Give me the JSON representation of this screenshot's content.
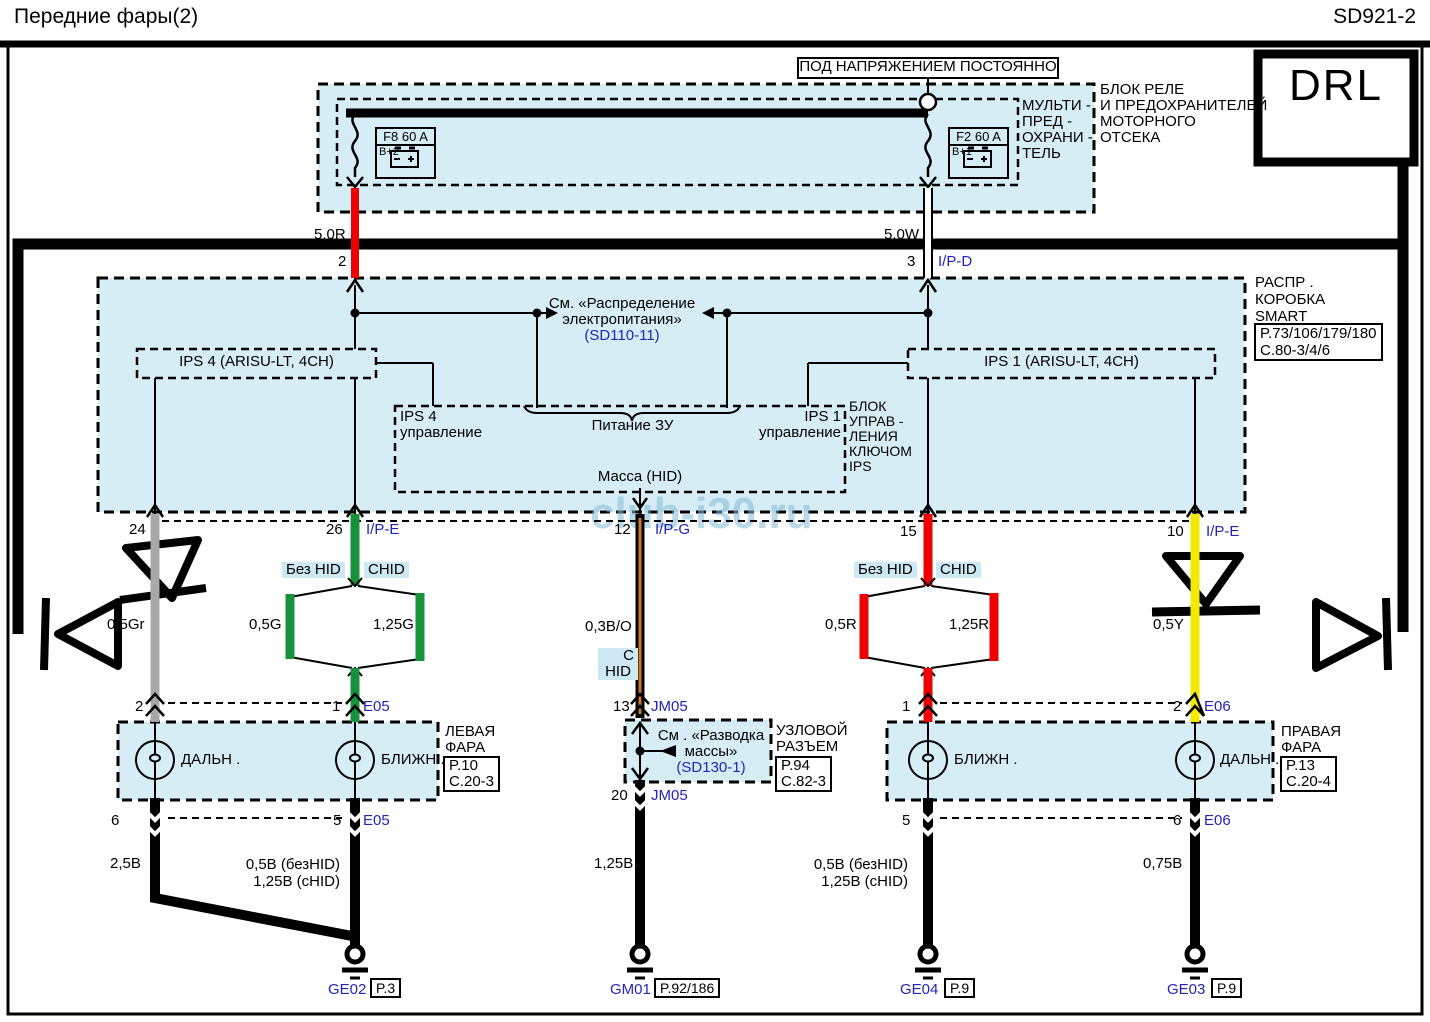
{
  "header": {
    "title": "Передние  фары(2)",
    "code": "SD921-2"
  },
  "drl": "DRL",
  "watermark": "club-i30.ru",
  "power_label": "ПОД НАПРЯЖЕНИЕМ    ПОСТОЯННО",
  "engine_fusebox": {
    "line1": "БЛОК  РЕЛЕ",
    "line2": "И ПРЕДОХРАНИТЕЛЕЙ",
    "line3": "МОТОРНОГО",
    "line4": "ОТСЕКА",
    "multi1": "МУЛЬТИ -",
    "multi2": "ПРЕД -",
    "multi3": "ОХРАНИ -",
    "multi4": "ТЕЛЬ",
    "fuse_f8": {
      "name": "F8 60 A",
      "terminal": "B+2"
    },
    "fuse_f2": {
      "name": "F2 60 A",
      "terminal": "B+1"
    }
  },
  "feeds": {
    "left": {
      "wire": "5.0R",
      "pin": "2"
    },
    "right": {
      "wire": "5.0W",
      "pin": "3",
      "connector": "I/P-D"
    }
  },
  "ips_block": {
    "see1": "См. «Распределение",
    "see2": "электропитания»",
    "see3": "(SD110-11)",
    "ips4": "IPS 4 (ARISU-LT, 4CH)",
    "ips1": "IPS 1 (ARISU-LT, 4CH)",
    "ctrl4a": "IPS 4",
    "ctrl4b": "управление",
    "supply": "Питание ЗУ",
    "ctrl1a": "IPS 1",
    "ctrl1b": "управление",
    "mass": "Масса (HID)",
    "name1": "БЛОК",
    "name2": "УПРАВ -",
    "name3": "ЛЕНИЯ",
    "name4": "КЛЮЧОМ",
    "name5": "IPS"
  },
  "smart_box": {
    "line1": "РАСПР .",
    "line2": "КОРОБКА",
    "line3": "SMART",
    "ref1": "P.73/106/179/180",
    "ref2": "C.80-3/4/6"
  },
  "outputs": {
    "p24": "24",
    "p26": "26",
    "c26": "I/P-E",
    "p12": "12",
    "c12": "I/P-G",
    "p15": "15",
    "p10": "10",
    "c10": "I/P-E",
    "left_nohid": "Без HID",
    "left_hid": "CHID",
    "right_nohid": "Без HID",
    "right_hid": "CHID",
    "w_gray": "0,5Gr",
    "w_g1": "0,5G",
    "w_g2": "1,25G",
    "w_bo": "0,3B/O",
    "hid_c1": "C",
    "hid_c2": "HID",
    "w_r1": "0,5R",
    "w_r2": "1,25R",
    "w_y": "0,5Y"
  },
  "left_lamp": {
    "pin_a": "2",
    "pin_b": "1",
    "conn_top": "E05",
    "bulb1": "ДАЛЬН .",
    "bulb2": "БЛИЖН .",
    "name1": "ЛЕВАЯ",
    "name2": "ФАРА",
    "ref1": "P.10",
    "ref2": "C.20-3",
    "pin_c": "6",
    "pin_d": "5",
    "conn_bot": "E05",
    "w1": "2,5B",
    "w2a": "0,5B (безHID)",
    "w2b": "1,25B (cHID)"
  },
  "junction": {
    "pin_top": "13",
    "conn_top": "JM05",
    "see1": "См . «Разводка",
    "see2": "массы»",
    "see3": "(SD130-1)",
    "name1": "УЗЛОВОЙ",
    "name2": "РАЗЪЕМ",
    "ref1": "P.94",
    "ref2": "C.82-3",
    "pin_bot": "20",
    "conn_bot": "JM05",
    "w": "1,25B"
  },
  "right_lamp": {
    "pin_a": "1",
    "pin_b": "2",
    "conn_top": "E06",
    "bulb1": "БЛИЖН .",
    "bulb2": "ДАЛЬН .",
    "name1": "ПРАВАЯ",
    "name2": "ФАРА",
    "ref1": "P.13",
    "ref2": "C.20-4",
    "pin_c": "5",
    "pin_d": "6",
    "conn_bot": "E06",
    "w1a": "0,5B (безHID)",
    "w1b": "1,25B (cHID)",
    "w2": "0,75B"
  },
  "grounds": {
    "g1": "GE02",
    "g1ref": "P.3",
    "g2": "GM01",
    "g2ref": "P.92/186",
    "g3": "GE04",
    "g3ref": "P.9",
    "g4": "GE03",
    "g4ref": "P.9"
  },
  "colors": {
    "block_fill": "#d7edf5",
    "tag_fill": "#cde9f3",
    "wire_red": "#ee0000",
    "wire_green": "#18923a",
    "wire_gray": "#a8a8a8",
    "wire_yellow": "#f2ea00",
    "wire_orange": "#c87a28",
    "ref_text": "#2323bb"
  }
}
